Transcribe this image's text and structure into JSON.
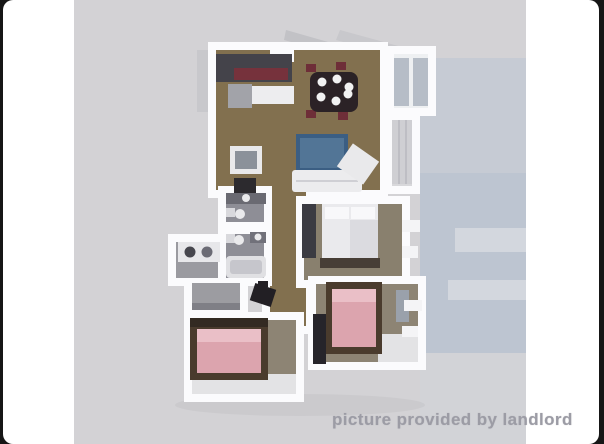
{
  "photo": {
    "watermark": "picture provided by landlord",
    "watermark_color": "#9c9ca5",
    "background": "#d3d2d5",
    "frame_color": "#161616",
    "page_color": "#ffffff"
  },
  "floorplan": {
    "type": "3d-rendered-floor-plan-top-view",
    "rooms": [
      "kitchen",
      "dining-area",
      "living-area",
      "balcony",
      "bedroom-middle",
      "bathroom-upper",
      "bathroom-lower",
      "laundry-alcove",
      "hallway",
      "closet-nook",
      "bedroom-bottom-left",
      "bedroom-bottom-right"
    ],
    "colors": {
      "walls": "#fbfbfd",
      "wood_floor": "#82704f",
      "bedroom_floor": "#8d8474",
      "bathroom_floor": "#8e8e96",
      "bed_pink": "#dca4ae",
      "bed_pillow_pink": "#eabfc7",
      "bed_frame_brown": "#4a3b2d",
      "sofa_blue": "#3b5e83",
      "kitchen_counter_dark": "#44434a",
      "kitchen_accent_maroon": "#76323c",
      "dining_table_dark": "#2b2226",
      "background_band_blue": "#bdc5d1"
    }
  }
}
